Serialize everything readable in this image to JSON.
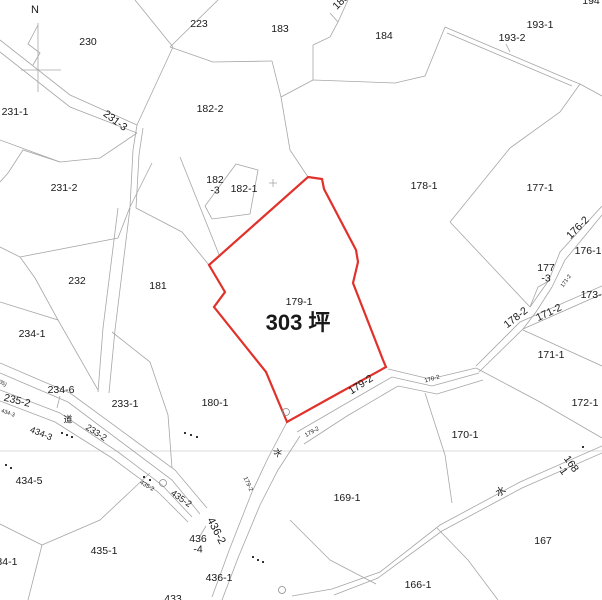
{
  "map": {
    "width": 602,
    "height": 600,
    "background": "#ffffff",
    "line_color": "#a6a6a6",
    "section_line_color": "#cfcfcf",
    "text_color": "#191919",
    "red_color": "#e0312b",
    "red_parcel": {
      "number": "179-1",
      "area": "303 坪",
      "points": "308,177 322,179 324,189 356,250 358,262 353,283 383,360 386,367 330,398 287,422 266,372 214,307 225,292 209,265"
    },
    "section_lines": [
      "0,451 602,451"
    ],
    "lines": [
      "0,40 70,95 137,125",
      "0,52 70,107 137,133",
      "137,125 133,150 130,207",
      "143,128 139,155 136,208",
      "135,0 173,47",
      "173,47 137,125",
      "218,0 170,47",
      "170,47 213,62 272,61",
      "272,61 281,97",
      "281,97 290,150 308,177",
      "348,0 338,22 330,37 313,45",
      "330,13 338,22",
      "313,45 313,80",
      "313,80 281,97",
      "313,80 395,83 425,76 445,27",
      "445,27 570,80 580,84",
      "447,33 572,86",
      "580,84 602,96",
      "580,84 560,112 510,148",
      "510,148 450,222",
      "450,222 530,307",
      "602,206 560,252 549,280",
      "602,215 565,260 552,287",
      "549,280 530,307",
      "552,287 536,312 523,329",
      "530,307 538,287 549,281",
      "602,286 520,322 476,366",
      "602,294 523,329 479,372",
      "476,368 430,379 388,369",
      "479,373 432,386 392,377 340,407 297,432",
      "483,380 437,394 398,386 347,416 304,444",
      "287,422 268,458 252,492 230,548 212,597",
      "300,436 278,470 260,505 238,558 222,600",
      "476,368 540,402 602,438",
      "523,330 602,366",
      "425,393 445,455 452,503",
      "602,446 520,482 440,525 380,572 332,589 292,596",
      "602,453 522,488 442,531 378,578 334,595",
      "437,528 468,560 498,600",
      "330,560 376,584",
      "290,520 330,560",
      "0,247 20,257 118,238 130,207",
      "20,257 35,278 58,320",
      "130,207 152,163",
      "136,208 182,232 209,265",
      "180,157 220,257",
      "236,164 205,206 212,219 250,214 258,170 236,164",
      "118,208 103,328",
      "130,208 115,330",
      "103,328 98,392",
      "115,330 109,393",
      "0,302 58,320 98,390",
      "112,332 150,362 168,415 172,468",
      "0,140 60,162 100,158 137,133",
      "0,182 8,173 23,150 60,162",
      "0,363 70,393 130,437 175,470 207,508",
      "0,373 68,402 128,447 172,480 200,514",
      "0,390 60,413 118,452 162,485 192,517",
      "0,401 55,422 112,458 158,492 188,522",
      "0,524 42,545",
      "42,545 28,600",
      "42,545 100,520 150,473",
      "60,396 57,408",
      "200,536 206,526",
      "506,44 510,52",
      "38,23 38,92",
      "21,70 61,70",
      "38,25 28,44 40,53 33,65"
    ],
    "labels": [
      {
        "t": "N",
        "x": 35,
        "y": 10,
        "s": 11,
        "n": "compass-north-letter"
      },
      {
        "t": "230",
        "x": 88,
        "y": 42
      },
      {
        "t": "223",
        "x": 199,
        "y": 24
      },
      {
        "t": "183",
        "x": 280,
        "y": 29
      },
      {
        "t": "185",
        "x": 341,
        "y": 2,
        "r": -45
      },
      {
        "t": "184",
        "x": 384,
        "y": 36
      },
      {
        "t": "194",
        "x": 591,
        "y": 1
      },
      {
        "t": "193-1",
        "x": 540,
        "y": 25
      },
      {
        "t": "193-2",
        "x": 512,
        "y": 38
      },
      {
        "t": "231-1",
        "x": 15,
        "y": 112
      },
      {
        "t": "231-3",
        "x": 115,
        "y": 121,
        "r": 37
      },
      {
        "t": "182-2",
        "x": 210,
        "y": 109
      },
      {
        "t": "231-2",
        "x": 64,
        "y": 188
      },
      {
        "t": "178-1",
        "x": 424,
        "y": 186
      },
      {
        "t": "177-1",
        "x": 540,
        "y": 188
      },
      {
        "t": "182-1",
        "x": 244,
        "y": 189
      },
      {
        "t": "182-3",
        "x": 215,
        "y": 180,
        "ml": [
          "182",
          "-3"
        ]
      },
      {
        "t": "176-2",
        "x": 578,
        "y": 228,
        "r": -45
      },
      {
        "t": "176-1",
        "x": 588,
        "y": 251
      },
      {
        "t": "177-3",
        "x": 546,
        "y": 268,
        "ml": [
          "177",
          "-3"
        ]
      },
      {
        "t": "171-2",
        "x": 566,
        "y": 281,
        "r": -55,
        "s": 5.5
      },
      {
        "t": "173-1",
        "x": 594,
        "y": 295
      },
      {
        "t": "232",
        "x": 77,
        "y": 281
      },
      {
        "t": "181",
        "x": 158,
        "y": 286
      },
      {
        "t": "179-1",
        "x": 299,
        "y": 302,
        "n": "parcel-179-1-number"
      },
      {
        "t": "303 坪",
        "x": 298,
        "y": 324,
        "s": 22,
        "c": "red",
        "b": true,
        "n": "parcel-179-1-area"
      },
      {
        "t": "178-2",
        "x": 516,
        "y": 318,
        "r": -38
      },
      {
        "t": "171-2",
        "x": 549,
        "y": 313,
        "r": -25
      },
      {
        "t": "171-1",
        "x": 551,
        "y": 355
      },
      {
        "t": "172-1",
        "x": 585,
        "y": 403
      },
      {
        "t": "234-1",
        "x": 32,
        "y": 334
      },
      {
        "t": "234-6",
        "x": 61,
        "y": 390
      },
      {
        "t": "235-2",
        "x": 17,
        "y": 401,
        "r": 14
      },
      {
        "t": "(35)",
        "x": 2,
        "y": 383,
        "r": 30,
        "s": 5.5
      },
      {
        "t": "道",
        "x": 68,
        "y": 420,
        "s": 9
      },
      {
        "t": "434-3",
        "x": 8,
        "y": 413,
        "r": 20,
        "s": 5.5
      },
      {
        "t": "434-3",
        "x": 41,
        "y": 434,
        "r": 22,
        "s": 9
      },
      {
        "t": "233-2",
        "x": 96,
        "y": 433,
        "r": 33,
        "s": 9
      },
      {
        "t": "233-1",
        "x": 125,
        "y": 404
      },
      {
        "t": "180-1",
        "x": 215,
        "y": 403
      },
      {
        "t": "179-2",
        "x": 361,
        "y": 385,
        "r": -33
      },
      {
        "t": "170-2",
        "x": 432,
        "y": 379,
        "r": -15,
        "s": 6
      },
      {
        "t": "179-2",
        "x": 312,
        "y": 432,
        "r": -30,
        "s": 6
      },
      {
        "t": "水",
        "x": 277,
        "y": 453,
        "r": 60,
        "s": 9
      },
      {
        "t": "179-2",
        "x": 248,
        "y": 484,
        "r": 65,
        "s": 6
      },
      {
        "t": "170-1",
        "x": 465,
        "y": 435
      },
      {
        "t": "169-1",
        "x": 347,
        "y": 498
      },
      {
        "t": "水",
        "x": 501,
        "y": 492,
        "r": -30,
        "s": 10
      },
      {
        "t": "168-1",
        "x": 571,
        "y": 464,
        "r": 55,
        "ml": [
          "168",
          "-1"
        ]
      },
      {
        "t": "167",
        "x": 543,
        "y": 541
      },
      {
        "t": "166-1",
        "x": 418,
        "y": 585
      },
      {
        "t": "434-5",
        "x": 29,
        "y": 481
      },
      {
        "t": "434-1",
        "x": 4,
        "y": 562
      },
      {
        "t": "435-1",
        "x": 104,
        "y": 551
      },
      {
        "t": "435-2",
        "x": 147,
        "y": 486,
        "r": 30,
        "s": 6
      },
      {
        "t": "435-2",
        "x": 181,
        "y": 499,
        "r": 35,
        "s": 9
      },
      {
        "t": "436-2",
        "x": 216,
        "y": 531,
        "r": 63,
        "s": 11
      },
      {
        "t": "436-4",
        "x": 198,
        "y": 539,
        "ml": [
          "436",
          "-4"
        ]
      },
      {
        "t": "436-1",
        "x": 219,
        "y": 578
      },
      {
        "t": "433",
        "x": 173,
        "y": 599
      }
    ],
    "crosses": [
      {
        "x": 273,
        "y": 183
      }
    ],
    "dot_runs": [
      [
        [
          62,
          433
        ],
        [
          67,
          435
        ],
        [
          72,
          437
        ]
      ],
      [
        [
          185,
          433
        ],
        [
          191,
          435
        ],
        [
          197,
          437
        ]
      ],
      [
        [
          253,
          557
        ],
        [
          258,
          560
        ],
        [
          263,
          562
        ]
      ],
      [
        [
          144,
          477
        ],
        [
          150,
          480
        ]
      ],
      [
        [
          6,
          465
        ],
        [
          11,
          468
        ]
      ],
      [
        [
          583,
          447
        ]
      ]
    ],
    "circle_markers": [
      {
        "x": 286,
        "y": 412
      },
      {
        "x": 163,
        "y": 483
      },
      {
        "x": 282,
        "y": 590
      }
    ]
  }
}
